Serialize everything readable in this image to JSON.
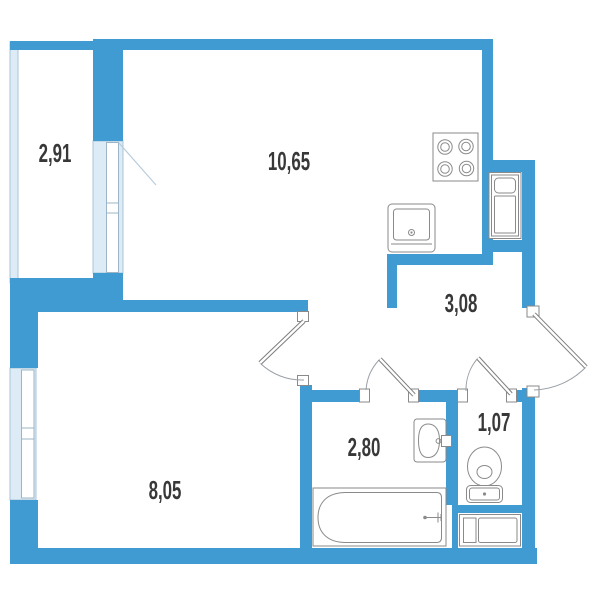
{
  "plan": {
    "type": "apartment-floor-plan",
    "rooms": [
      {
        "name": "balcony",
        "area": "2,91"
      },
      {
        "name": "kitchen-living-room",
        "area": "10,65"
      },
      {
        "name": "hallway",
        "area": "3,08"
      },
      {
        "name": "room",
        "area": "8,05"
      },
      {
        "name": "bathroom",
        "area": "2,80"
      },
      {
        "name": "wc",
        "area": "1,07"
      }
    ],
    "colors": {
      "wall": "#3F9BD2",
      "glazing": "#DCEBF5",
      "glazing_border": "#A7C4D8",
      "fixture_outline": "#8A8A8A",
      "door_arc": "#9AA0A6",
      "label": "#383838",
      "background": "#FFFFFF"
    },
    "fixtures": [
      "stove-icon",
      "kitchen-sink-icon",
      "built-in-wardrobe-icon",
      "washbasin-icon",
      "bathtub-icon",
      "toilet-icon",
      "washing-machine-icon"
    ],
    "doors": [
      "entrance-door",
      "room-door",
      "bathroom-door",
      "wc-door",
      "balcony-door"
    ],
    "windows": [
      "balcony-glazing",
      "balcony-window",
      "room-window"
    ]
  }
}
